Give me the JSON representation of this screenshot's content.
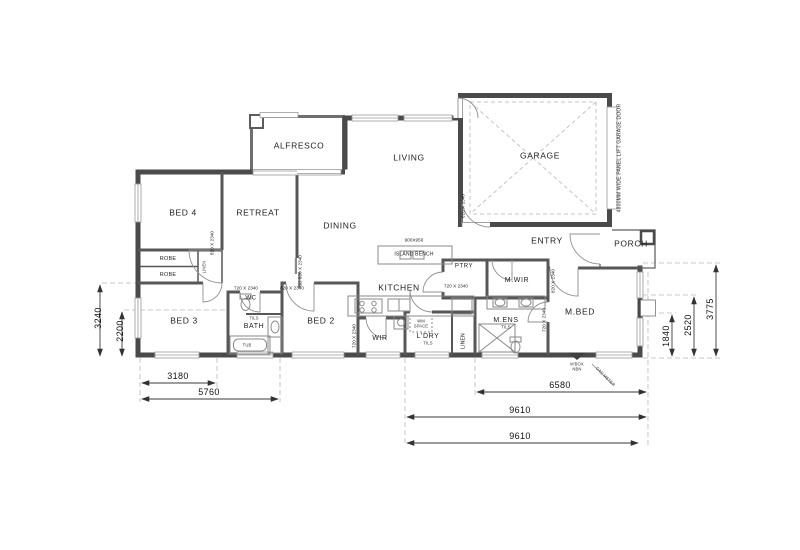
{
  "rooms": {
    "alfresco": "ALFRESCO",
    "living": "LIVING",
    "garage": "GARAGE",
    "bed4": "BED 4",
    "retreat": "RETREAT",
    "dining": "DINING",
    "entry": "ENTRY",
    "porch": "PORCH",
    "kitchen": "KITCHEN",
    "mwir": "M.WIR",
    "ptry": "PTRY",
    "robe_a": "ROBE",
    "robe_b": "ROBE",
    "linen_closet": "LINEN",
    "bed3": "BED 3",
    "wc": "WC",
    "bath": "BATH",
    "bed2": "BED 2",
    "wir": "WIR",
    "ldry": "L'DRY",
    "linen": "LINEN",
    "mens": "M.ENS",
    "mbed": "M.BED"
  },
  "fixtures": {
    "island_bench": "ISLAND BENCH",
    "island_size": "900X950",
    "wm_space": "WM\nSPACE",
    "tub": "TUB",
    "tiles": "TILS"
  },
  "doors": {
    "d820": "820 X 2340",
    "d720": "720 X 2340",
    "sd820": "SD 820 X 2340",
    "garage_door_note": "4800MM WIDE PANEL LIFT GARAGE DOOR"
  },
  "dims": {
    "left_outer": "3240",
    "left_inner": "2200",
    "bottom_3180": "3180",
    "bottom_5760": "5760",
    "bottom_6580": "6580",
    "bottom_9610_a": "9610",
    "bottom_9610_b": "9610",
    "right_1840": "1840",
    "right_2520": "2520",
    "right_3775": "3775"
  },
  "site": {
    "mbox": "M'BOX\nNBN",
    "meter": "GAS METER"
  }
}
